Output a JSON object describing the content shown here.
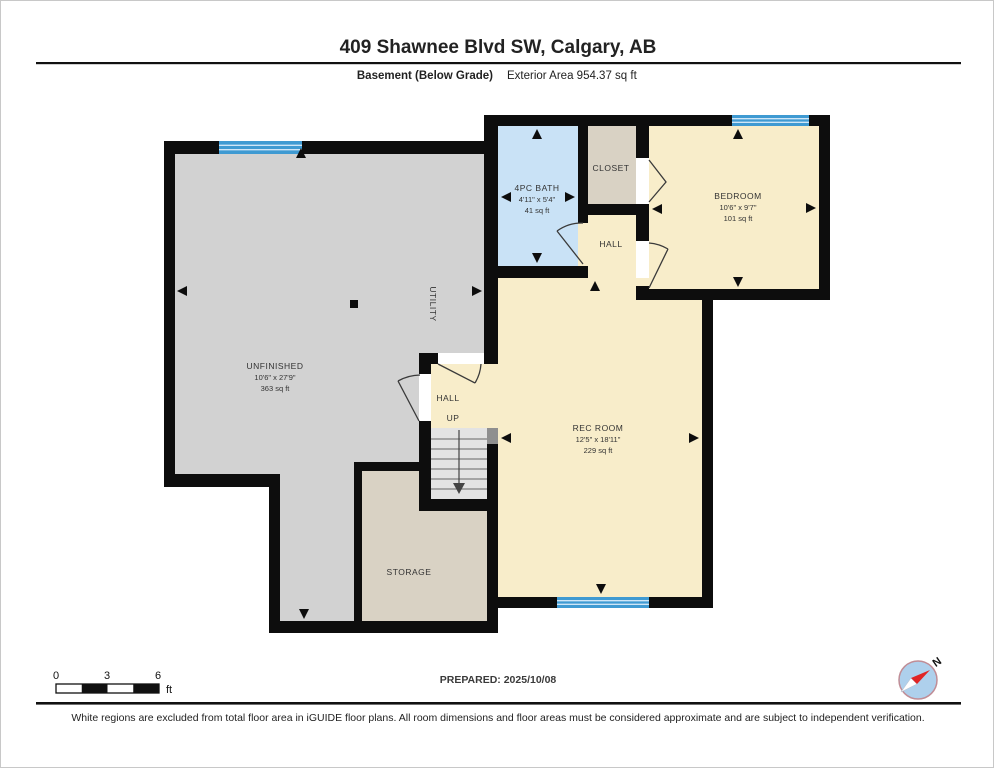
{
  "header": {
    "title": "409 Shawnee Blvd SW, Calgary, AB",
    "floor_label": "Basement (Below Grade)",
    "area_label": "Exterior Area 954.37 sq ft"
  },
  "rooms": {
    "unfinished": {
      "name": "UNFINISHED",
      "dims": "10'6\" x 27'9\"",
      "area": "363 sq ft"
    },
    "bath": {
      "name": "4PC BATH",
      "dims": "4'11\" x 5'4\"",
      "area": "41 sq ft"
    },
    "closet": {
      "name": "CLOSET"
    },
    "bedroom": {
      "name": "BEDROOM",
      "dims": "10'6\" x 9'7\"",
      "area": "101 sq ft"
    },
    "hall_upper": {
      "name": "HALL"
    },
    "rec_room": {
      "name": "REC ROOM",
      "dims": "12'5\" x 18'11\"",
      "area": "229 sq ft"
    },
    "hall_lower": {
      "name": "HALL"
    },
    "stairs": {
      "label": "UP"
    },
    "utility": {
      "name": "UTILITY"
    },
    "storage": {
      "name": "STORAGE"
    }
  },
  "scale_bar": {
    "ticks": [
      "0",
      "3",
      "6"
    ],
    "unit": "ft"
  },
  "footer": {
    "prepared": "PREPARED: 2025/10/08",
    "disclaimer": "White regions are excluded from total floor area in iGUIDE floor plans. All room dimensions and floor areas must be considered approximate and are subject to independent verification."
  },
  "compass": {
    "north_label": "N"
  },
  "colors": {
    "wall": "#0d0d0d",
    "unfinished_fill": "#d2d2d2",
    "finished_fill": "#f8edca",
    "bath_fill": "#c9e2f6",
    "tan_fill": "#d9d2c4",
    "stairs_fill": "#e3e3e3",
    "window_blue": "#3f9ad2"
  }
}
